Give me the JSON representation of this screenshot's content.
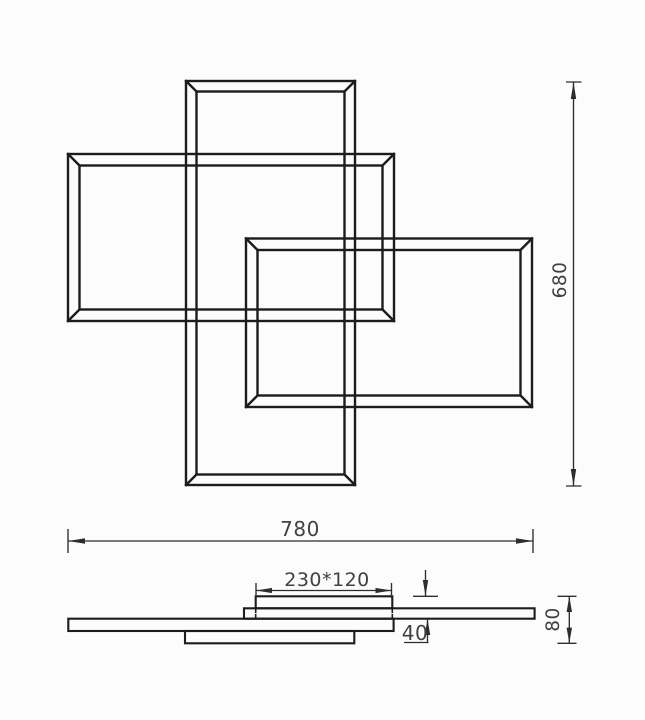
{
  "drawing": {
    "type": "technical-dimension-drawing",
    "views": [
      "top-view",
      "side-profile-view"
    ],
    "dimensions": {
      "overall_width": "780",
      "overall_height": "680",
      "canopy_size": "230*120",
      "canopy_drop": "40",
      "profile_height": "80"
    },
    "colors": {
      "background": "#fcfcfc",
      "object_line": "#1c1c1c",
      "dimension_line": "#2d2d2d",
      "dimension_text": "#414141"
    }
  }
}
